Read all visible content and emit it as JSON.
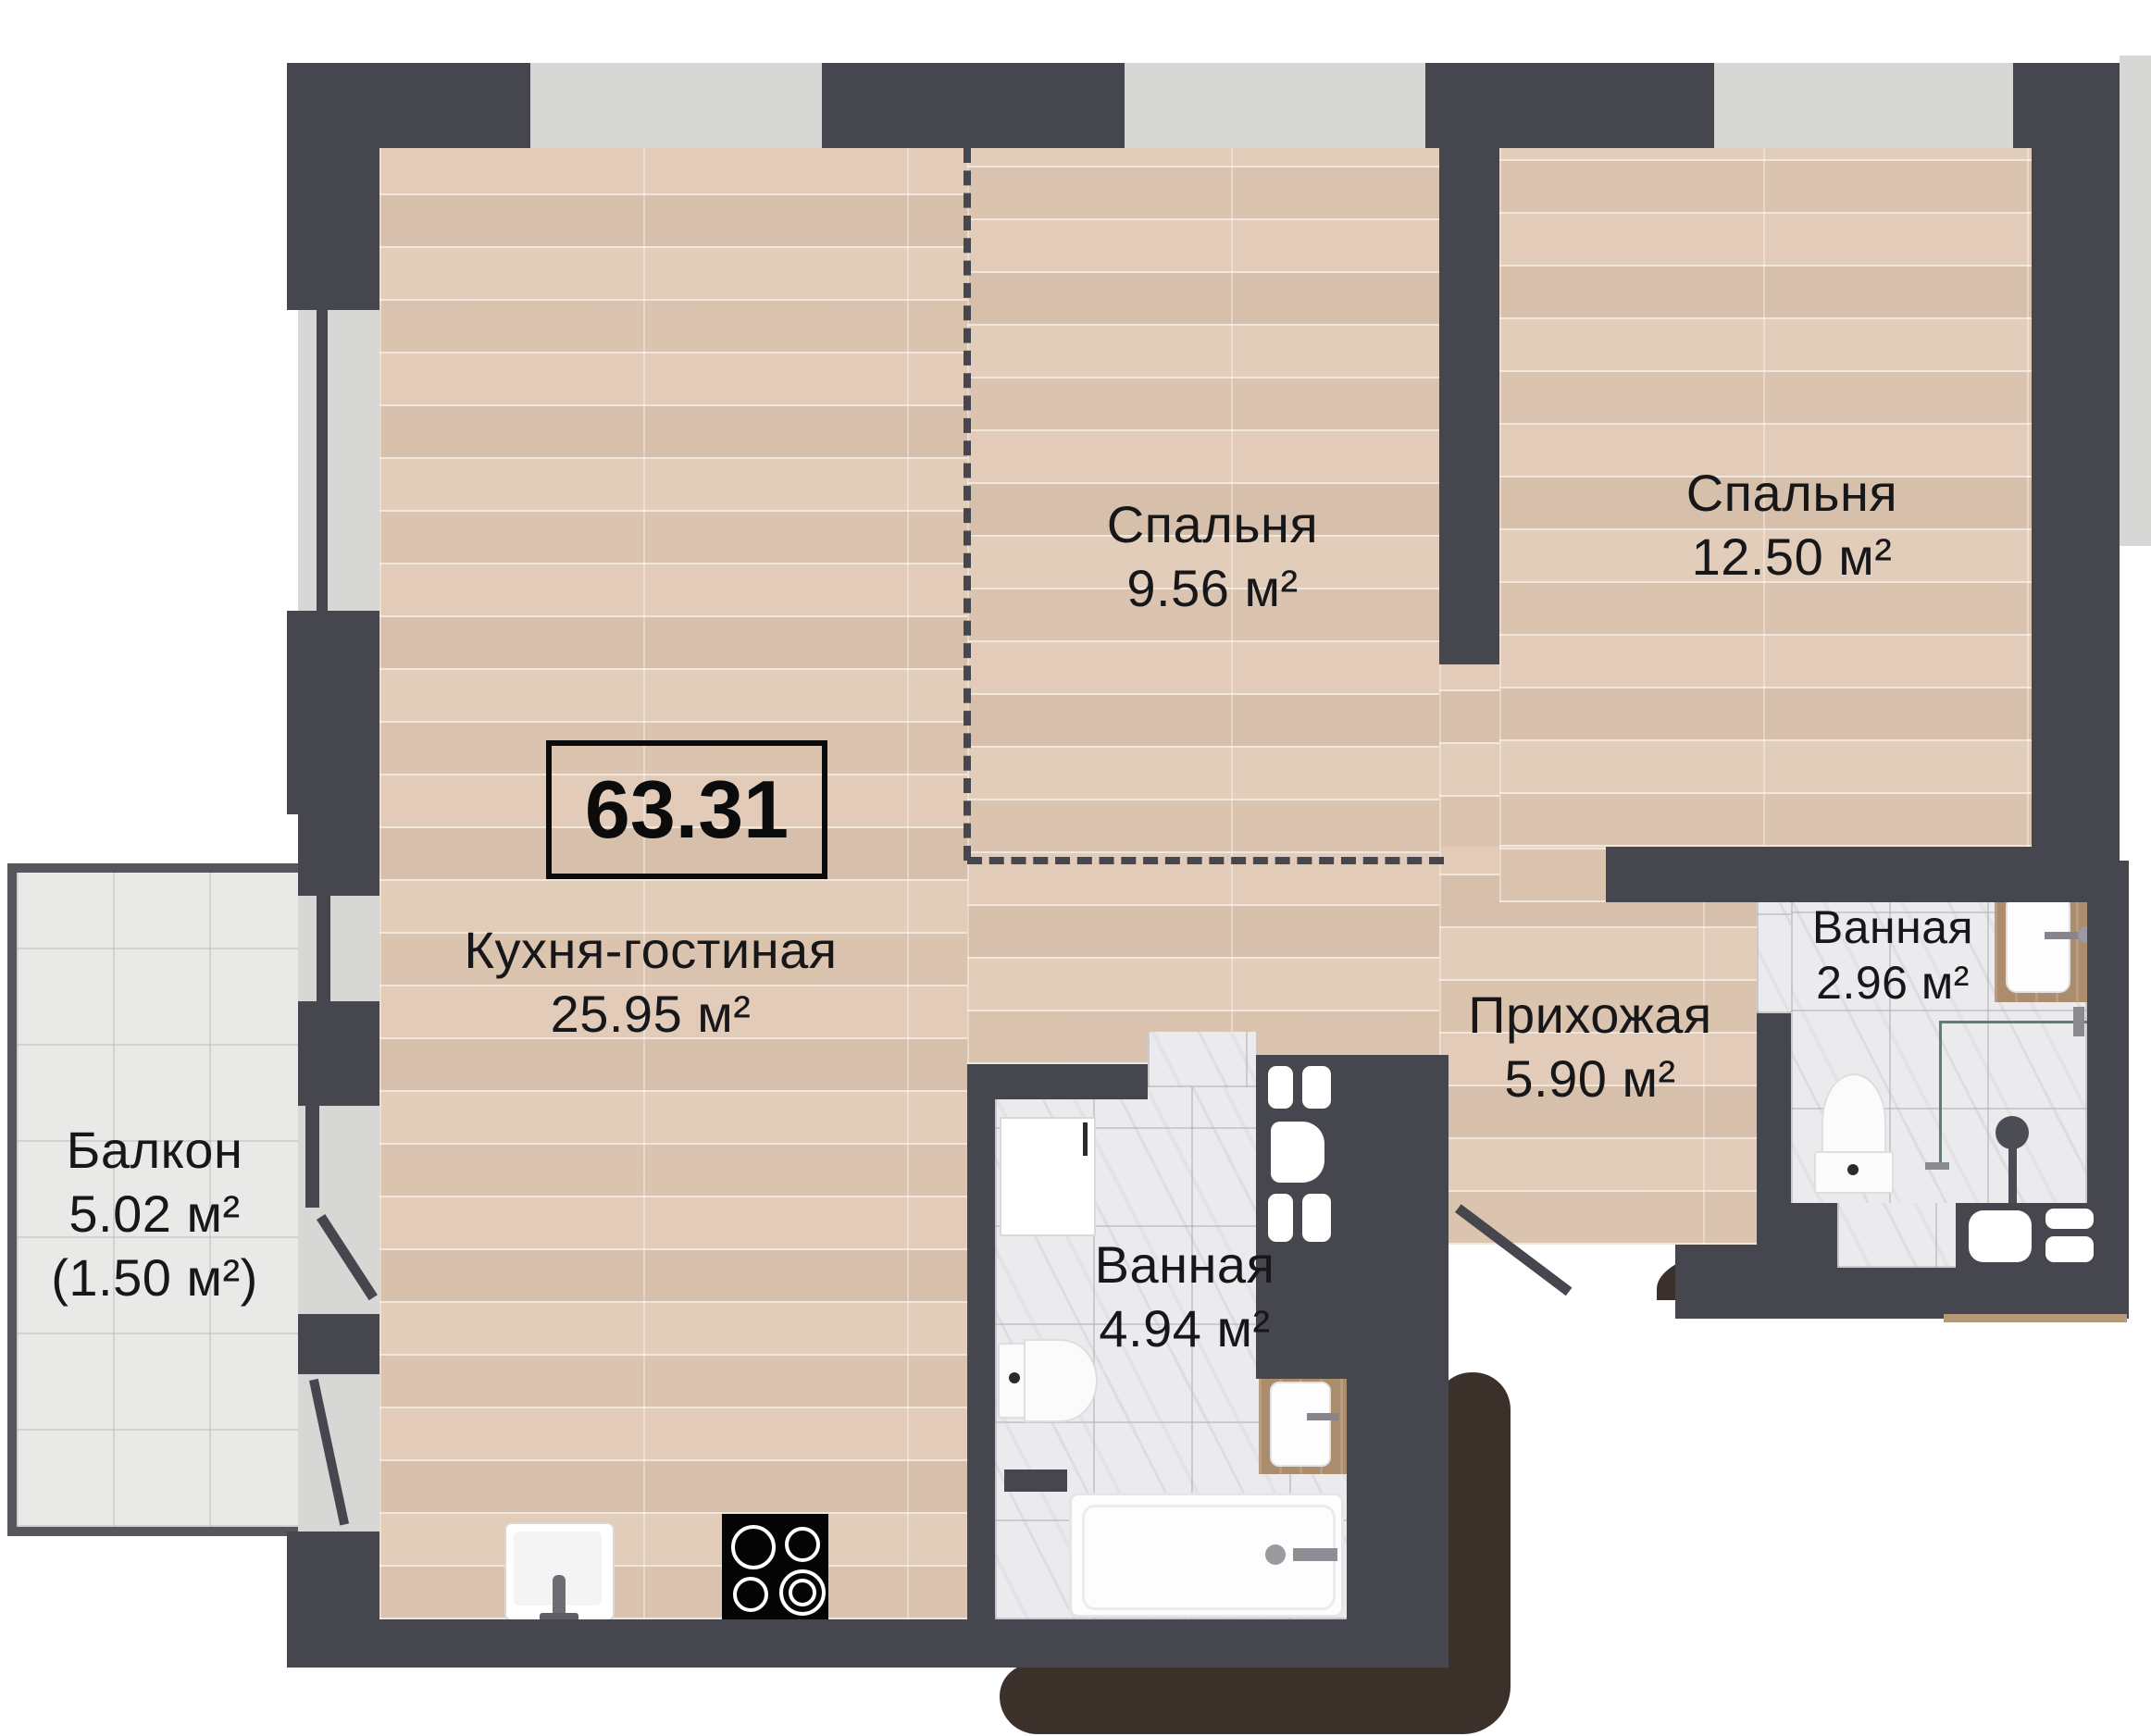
{
  "total_area": {
    "value": "63.31"
  },
  "rooms": {
    "kitchen_living": {
      "name": "Кухня-гостиная",
      "area": "25.95 м²"
    },
    "bedroom_small": {
      "name": "Спальня",
      "area": "9.56 м²"
    },
    "bedroom_large": {
      "name": "Спальня",
      "area": "12.50 м²"
    },
    "hallway": {
      "name": "Прихожая",
      "area": "5.90 м²"
    },
    "bathroom_main": {
      "name": "Ванная",
      "area": "4.94 м²"
    },
    "bathroom_second": {
      "name": "Ванная",
      "area": "2.96 м²"
    },
    "balcony": {
      "name": "Балкон",
      "area": "5.02 м²",
      "area_reduced": "(1.50 м²)"
    }
  },
  "colors": {
    "wall": "#46464e",
    "wood_floor": "#e2cdba",
    "marble_tile": "#ebebed",
    "balcony_tile": "#e9e9e7",
    "window_sill": "#d7d7d5",
    "drop_shadow": "#3b302a",
    "counter_wood": "#ab8d6d",
    "glass_partition": "#5d7f72",
    "stove": "#000000"
  }
}
